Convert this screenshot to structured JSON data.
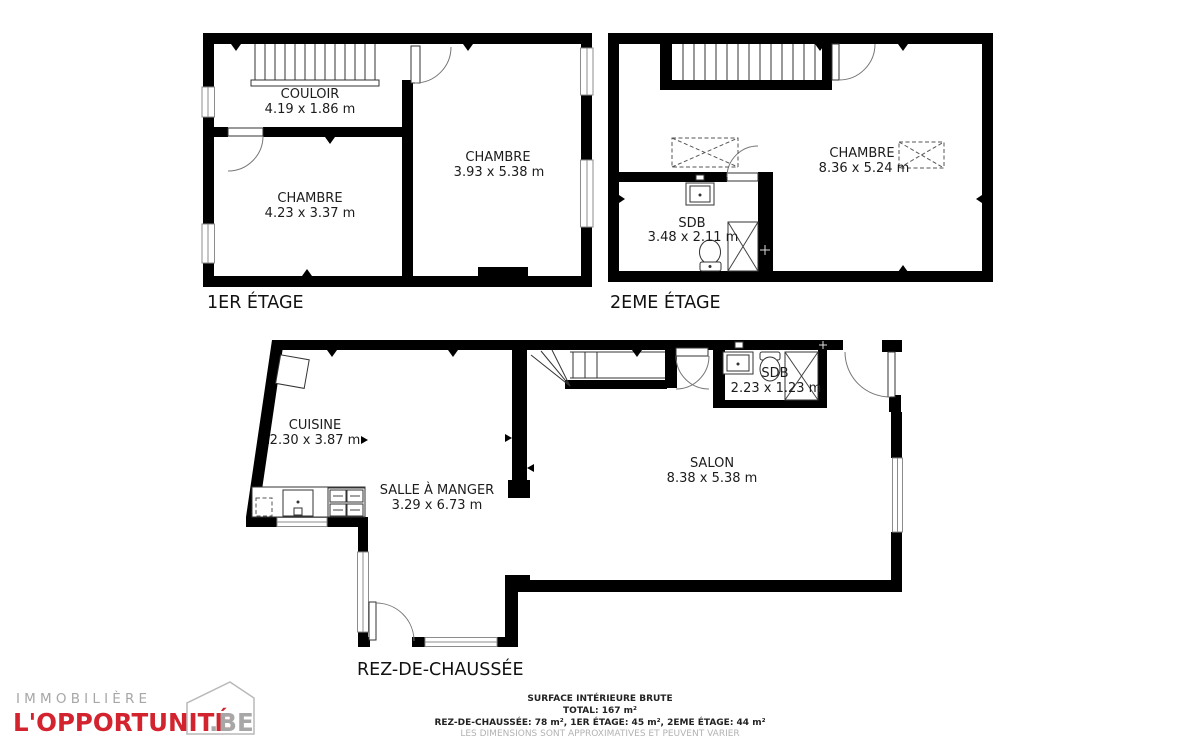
{
  "floors": {
    "first": {
      "label": "1ER ÉTAGE",
      "rooms": {
        "couloir": {
          "name": "COULOIR",
          "dims": "4.19 x 1.86 m"
        },
        "chambre1": {
          "name": "CHAMBRE",
          "dims": "4.23 x 3.37 m"
        },
        "chambre2": {
          "name": "CHAMBRE",
          "dims": "3.93 x 5.38 m"
        }
      }
    },
    "second": {
      "label": "2EME ÉTAGE",
      "rooms": {
        "chambre": {
          "name": "CHAMBRE",
          "dims": "8.36 x 5.24 m"
        },
        "sdb": {
          "name": "SDB",
          "dims": "3.48 x 2.11 m"
        }
      }
    },
    "ground": {
      "label": "REZ-DE-CHAUSSÉE",
      "rooms": {
        "cuisine": {
          "name": "CUISINE",
          "dims": "2.30 x 3.87 m"
        },
        "salle_a_manger": {
          "name": "SALLE À MANGER",
          "dims": "3.29 x 6.73 m"
        },
        "salon": {
          "name": "SALON",
          "dims": "8.38 x 5.38 m"
        },
        "sdb": {
          "name": "SDB",
          "dims": "2.23 x 1.23 m"
        }
      }
    }
  },
  "footer": {
    "title": "SURFACE INTÉRIEURE BRUTE",
    "total": "TOTAL: 167 m²",
    "breakdown": "REZ-DE-CHAUSSÉE: 78 m², 1ER ÉTAGE: 45 m², 2EME ÉTAGE: 44 m²",
    "disclaimer": "LES DIMENSIONS SONT APPROXIMATIVES ET PEUVENT VARIER"
  },
  "logo": {
    "line1": "IMMOBILIÈRE",
    "line2": "L'OPPORTUNITÉ",
    "line2_suffix": ".BE"
  },
  "colors": {
    "wall": "#000000",
    "logo_red": "#d2232e",
    "logo_gray": "#a7a7a7",
    "disclaimer_gray": "#b3b3b3"
  }
}
